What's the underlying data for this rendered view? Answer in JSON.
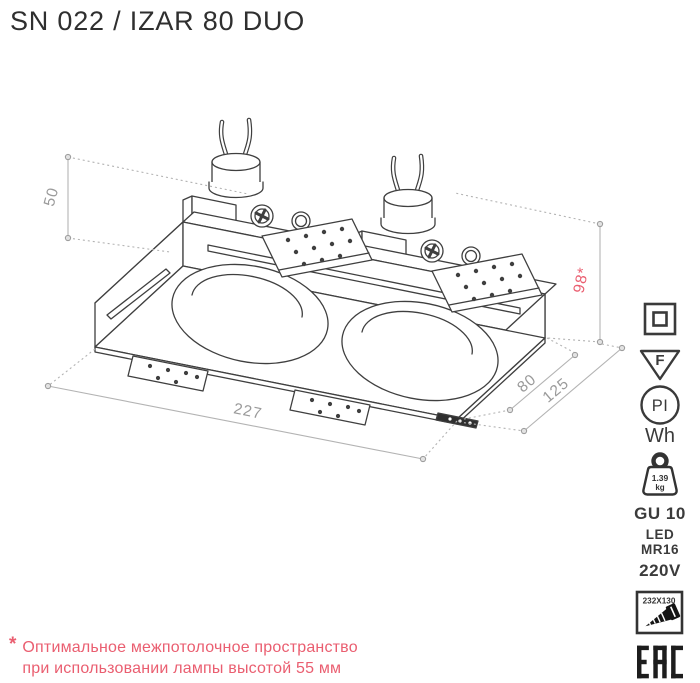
{
  "title": "SN 022 / IZAR 80 DUO",
  "drawing": {
    "dim_plenum": "50",
    "dim_depth": "98*",
    "dim_length": "227",
    "dim_width": "80",
    "dim_width_outer": "125"
  },
  "specs": {
    "f_mark": "F",
    "pi_mark": "PI",
    "wh_label": "Wh",
    "weight_value": "1.39",
    "weight_unit": "kg",
    "socket": "GU 10",
    "lamp_line1": "LED",
    "lamp_line2": "MR16",
    "voltage": "220V",
    "cutout_size": "232X130",
    "cert_mark": "EAC"
  },
  "note": {
    "marker": "*",
    "line1": "Оптимальное межпотолочное пространство",
    "line2": "при использовании лампы высотой 55 мм"
  },
  "colors": {
    "accent": "#ea5e70",
    "ink": "#3f3f3f",
    "dim": "#9a9a9a"
  }
}
